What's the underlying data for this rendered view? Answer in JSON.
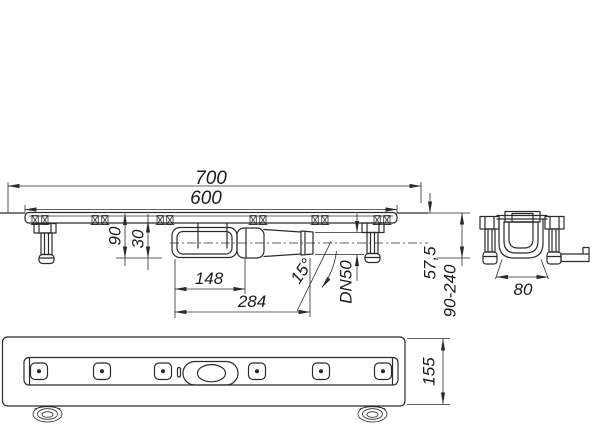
{
  "drawing": {
    "title": "drain-channel-dimension-drawing",
    "background": "#ffffff",
    "line_color": "#2b2b2b",
    "views": {
      "side": {
        "name": "side-elevation",
        "dims": {
          "overall": "700",
          "length": "600",
          "depth_total": "90",
          "depth_channel": "30",
          "trap_length": "148",
          "outlet_length": "284",
          "outlet_angle": "15°",
          "outlet_size": "DN50",
          "outlet_drop": "57,5",
          "install_height": "90-240"
        }
      },
      "end": {
        "name": "end-section",
        "dims": {
          "channel_width": "80"
        }
      },
      "plan": {
        "name": "bottom-plan",
        "dims": {
          "body_width": "155"
        }
      }
    }
  }
}
